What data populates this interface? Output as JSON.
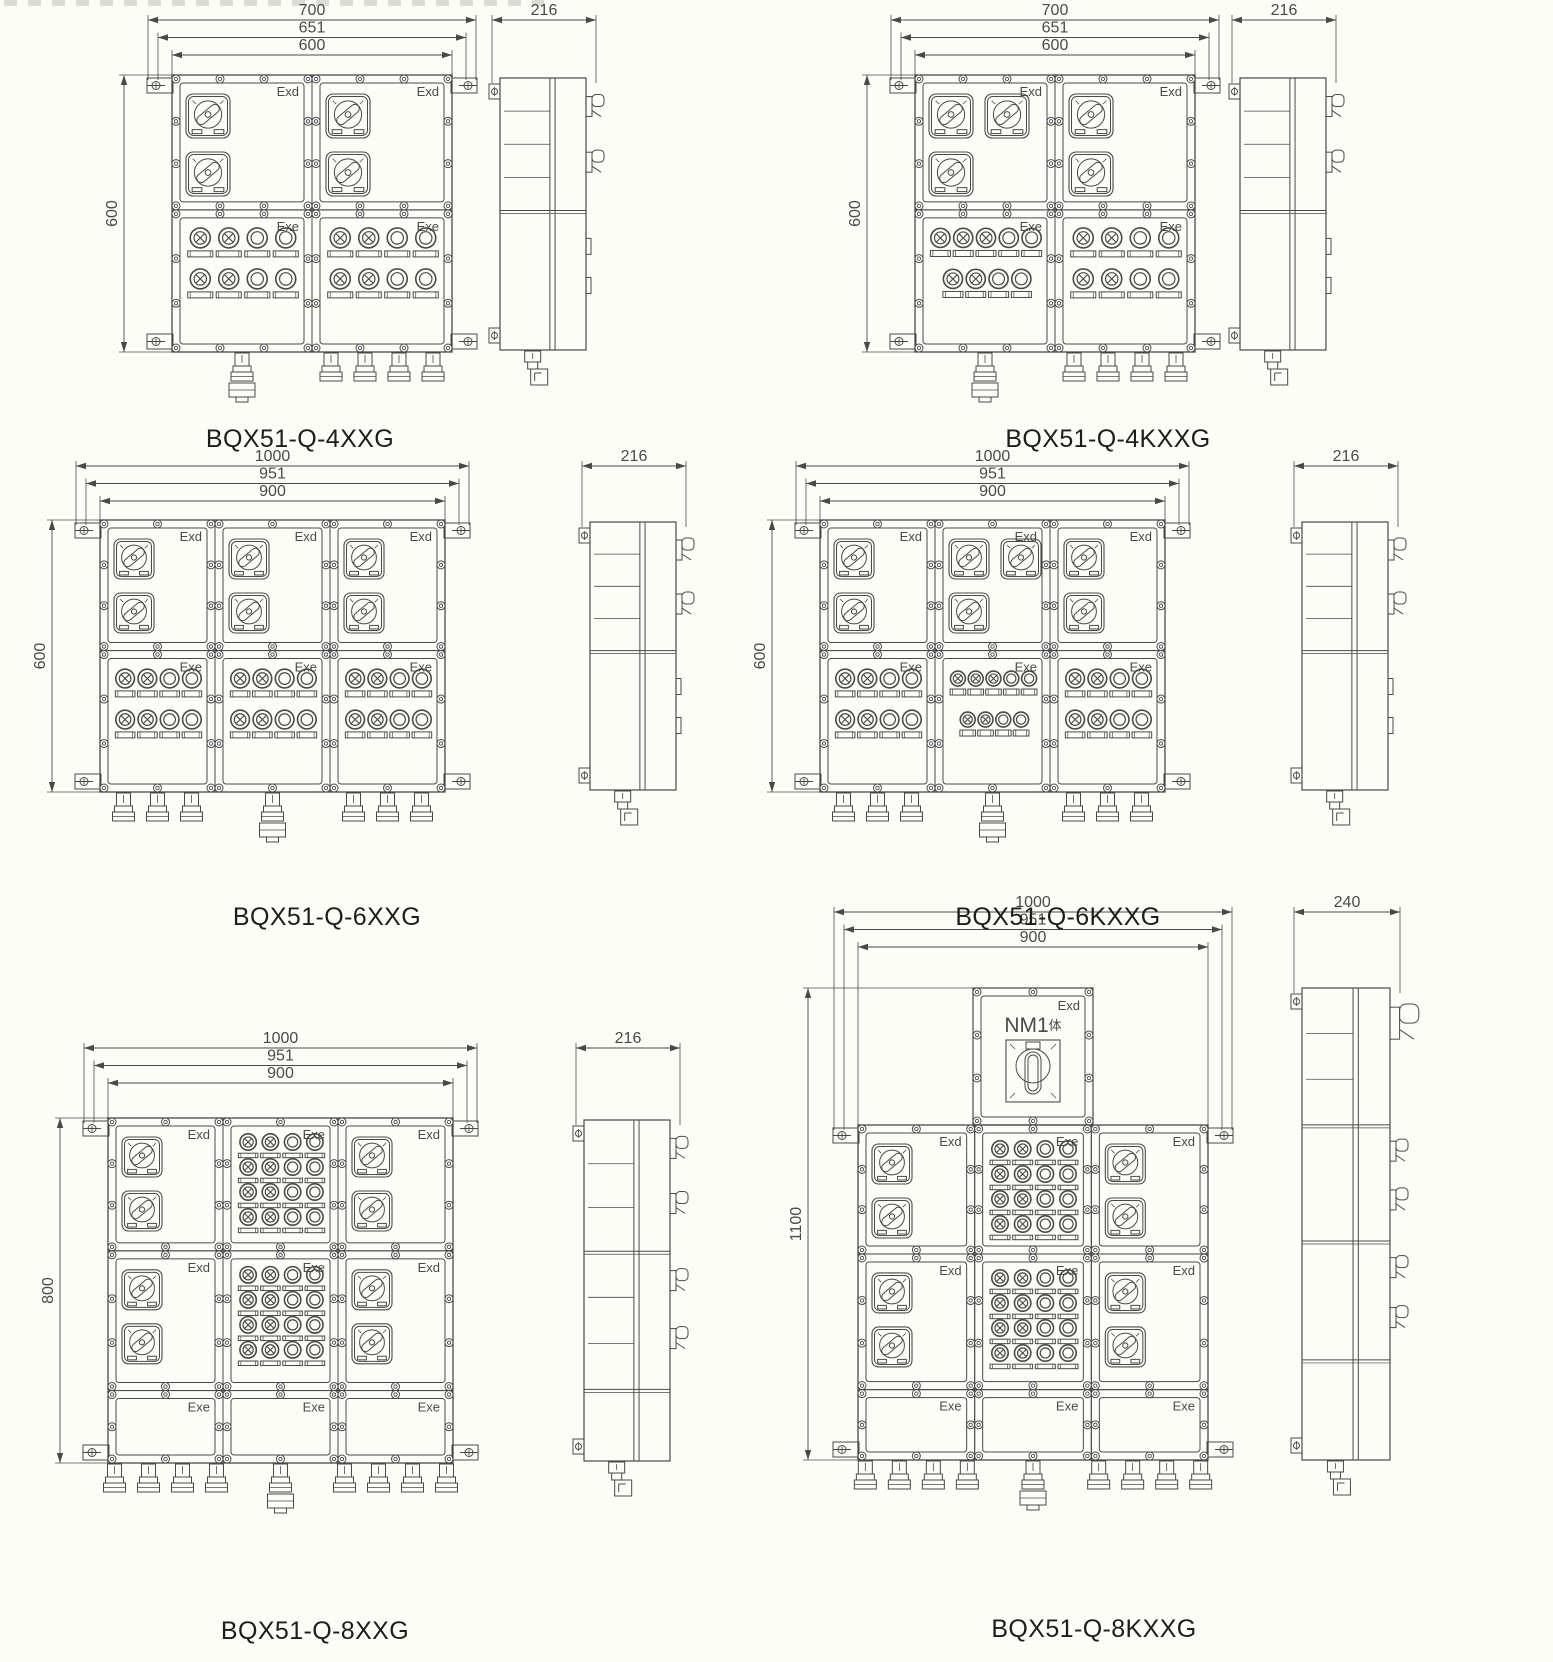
{
  "page": {
    "background": "#fdfdf8",
    "ink": "#494949",
    "caption_color": "#1d1d1d"
  },
  "figures": [
    {
      "id": "bqx51-q-4xxg",
      "caption": "BQX51-Q-4XXG",
      "dimensions": {
        "widths": [
          "700",
          "651",
          "600"
        ],
        "height": "600",
        "depth": "216"
      },
      "front": {
        "columns": 2,
        "rows": [
          {
            "cells": [
              {
                "type": "exd",
                "label": "Exd",
                "switches": [
                  [
                    0,
                    0
                  ],
                  [
                    0,
                    1
                  ]
                ]
              },
              {
                "type": "exd",
                "label": "Exd",
                "switches": [
                  [
                    0,
                    0
                  ],
                  [
                    0,
                    1
                  ]
                ]
              }
            ]
          },
          {
            "cells": [
              {
                "type": "exe",
                "label": "Exe",
                "circle_rows": [
                  "xxoo",
                  "xxoo"
                ]
              },
              {
                "type": "exe",
                "label": "Exe",
                "circle_rows": [
                  "xxoo",
                  "xxoo"
                ]
              }
            ]
          }
        ],
        "glands": [
          {
            "count": 1,
            "drain": true
          },
          {
            "count": 4,
            "drain": false
          }
        ]
      },
      "side": {
        "sections": [
          {
            "handles": 2,
            "shelves": 3
          },
          {
            "tabs": 2
          }
        ]
      }
    },
    {
      "id": "bqx51-q-4kxxg",
      "caption": "BQX51-Q-4KXXG",
      "dimensions": {
        "widths": [
          "700",
          "651",
          "600"
        ],
        "height": "600",
        "depth": "216"
      },
      "front": {
        "columns": 2,
        "rows": [
          {
            "cells": [
              {
                "type": "exd",
                "label": "Exd",
                "switches": [
                  [
                    0,
                    0
                  ],
                  [
                    1,
                    0
                  ],
                  [
                    0,
                    1
                  ]
                ]
              },
              {
                "type": "exd",
                "label": "Exd",
                "switches": [
                  [
                    0,
                    0
                  ],
                  [
                    0,
                    1
                  ]
                ]
              }
            ]
          },
          {
            "cells": [
              {
                "type": "exe",
                "label": "Exe",
                "circle_rows": [
                  "xxxoo",
                  "+xxoo"
                ]
              },
              {
                "type": "exe",
                "label": "Exe",
                "circle_rows": [
                  "xxoo",
                  "xxoo"
                ]
              }
            ]
          }
        ],
        "glands": [
          {
            "count": 1,
            "drain": true
          },
          {
            "count": 4,
            "drain": false
          }
        ]
      },
      "side": {
        "sections": [
          {
            "handles": 2,
            "shelves": 3
          },
          {
            "tabs": 2
          }
        ]
      }
    },
    {
      "id": "bqx51-q-6xxg",
      "caption": "BQX51-Q-6XXG",
      "dimensions": {
        "widths": [
          "1000",
          "951",
          "900"
        ],
        "height": "600",
        "depth": "216"
      },
      "front": {
        "columns": 3,
        "rows": [
          {
            "cells": [
              {
                "type": "exd",
                "label": "Exd",
                "switches": [
                  [
                    0,
                    0
                  ],
                  [
                    0,
                    1
                  ]
                ]
              },
              {
                "type": "exd",
                "label": "Exd",
                "switches": [
                  [
                    0,
                    0
                  ],
                  [
                    0,
                    1
                  ]
                ]
              },
              {
                "type": "exd",
                "label": "Exd",
                "switches": [
                  [
                    0,
                    0
                  ],
                  [
                    0,
                    1
                  ]
                ]
              }
            ]
          },
          {
            "cells": [
              {
                "type": "exe",
                "label": "Exe",
                "circle_rows": [
                  "xxoo",
                  "xxoo"
                ]
              },
              {
                "type": "exe",
                "label": "Exe",
                "circle_rows": [
                  "xxoo",
                  "xxoo"
                ]
              },
              {
                "type": "exe",
                "label": "Exe",
                "circle_rows": [
                  "xxoo",
                  "xxoo"
                ]
              }
            ]
          }
        ],
        "glands": [
          {
            "count": 3,
            "drain": false
          },
          {
            "count": 1,
            "drain": true
          },
          {
            "count": 3,
            "drain": false
          }
        ]
      },
      "side": {
        "sections": [
          {
            "handles": 2,
            "shelves": 3
          },
          {
            "tabs": 2
          }
        ]
      }
    },
    {
      "id": "bqx51-q-6kxxg",
      "caption": "BQX51-Q-6KXXG",
      "dimensions": {
        "widths": [
          "1000",
          "951",
          "900"
        ],
        "height": "600",
        "depth": "216"
      },
      "front": {
        "columns": 3,
        "rows": [
          {
            "cells": [
              {
                "type": "exd",
                "label": "Exd",
                "switches": [
                  [
                    0,
                    0
                  ],
                  [
                    0,
                    1
                  ]
                ]
              },
              {
                "type": "exd",
                "label": "Exd",
                "switches": [
                  [
                    0,
                    0
                  ],
                  [
                    1,
                    0
                  ],
                  [
                    0,
                    1
                  ]
                ]
              },
              {
                "type": "exd",
                "label": "Exd",
                "switches": [
                  [
                    0,
                    0
                  ],
                  [
                    0,
                    1
                  ]
                ]
              }
            ]
          },
          {
            "cells": [
              {
                "type": "exe",
                "label": "Exe",
                "circle_rows": [
                  "xxoo",
                  "xxoo"
                ]
              },
              {
                "type": "exe",
                "label": "Exe",
                "circle_rows": [
                  "xxxoo",
                  "+xxoo"
                ]
              },
              {
                "type": "exe",
                "label": "Exe",
                "circle_rows": [
                  "xxoo",
                  "xxoo"
                ]
              }
            ]
          }
        ],
        "glands": [
          {
            "count": 3,
            "drain": false
          },
          {
            "count": 1,
            "drain": true
          },
          {
            "count": 3,
            "drain": false
          }
        ]
      },
      "side": {
        "sections": [
          {
            "handles": 2,
            "shelves": 3
          },
          {
            "tabs": 2
          }
        ]
      }
    },
    {
      "id": "bqx51-q-8xxg",
      "caption": "BQX51-Q-8XXG",
      "dimensions": {
        "widths": [
          "1000",
          "951",
          "900"
        ],
        "height": "800",
        "depth": "216"
      },
      "front": {
        "columns": 3,
        "rows": [
          {
            "cells": [
              {
                "type": "exd",
                "label": "Exd",
                "switches": [
                  [
                    0,
                    0
                  ],
                  [
                    0,
                    1
                  ]
                ]
              },
              {
                "type": "exe",
                "label": "Exe",
                "circle_rows": [
                  "xxoo",
                  "xxoo",
                  "xxoo",
                  "xxoo"
                ]
              },
              {
                "type": "exd",
                "label": "Exd",
                "switches": [
                  [
                    0,
                    0
                  ],
                  [
                    0,
                    1
                  ]
                ]
              }
            ]
          },
          {
            "cells": [
              {
                "type": "exd",
                "label": "Exd",
                "switches": [
                  [
                    0,
                    0
                  ],
                  [
                    0,
                    1
                  ]
                ]
              },
              {
                "type": "exe",
                "label": "Exe",
                "circle_rows": [
                  "xxoo",
                  "xxoo",
                  "xxoo",
                  "xxoo"
                ]
              },
              {
                "type": "exd",
                "label": "Exd",
                "switches": [
                  [
                    0,
                    0
                  ],
                  [
                    0,
                    1
                  ]
                ]
              }
            ]
          },
          {
            "cells": [
              {
                "type": "exe",
                "label": "Exe"
              },
              {
                "type": "exe",
                "label": "Exe"
              },
              {
                "type": "exe",
                "label": "Exe"
              }
            ]
          }
        ],
        "glands": [
          {
            "count": 4,
            "drain": false
          },
          {
            "count": 1,
            "drain": true
          },
          {
            "count": 4,
            "drain": false
          }
        ]
      },
      "side": {
        "sections": [
          {
            "handles": 2,
            "shelves": 2
          },
          {
            "handles": 2,
            "shelves": 2
          },
          {}
        ]
      }
    },
    {
      "id": "bqx51-q-8kxxg",
      "caption": "BQX51-Q-8KXXG",
      "dimensions": {
        "widths": [
          "1000",
          "951",
          "900"
        ],
        "height": "1100",
        "depth": "240"
      },
      "top_compartment": {
        "label": "Exd",
        "title": "NM1",
        "title_suffix": "体"
      },
      "front": {
        "columns": 3,
        "rows": [
          {
            "cells": [
              {
                "type": "exd",
                "label": "Exd",
                "switches": [
                  [
                    0,
                    0
                  ],
                  [
                    0,
                    1
                  ]
                ]
              },
              {
                "type": "exe",
                "label": "Exe",
                "circle_rows": [
                  "xxoo",
                  "xxoo",
                  "xxoo",
                  "xxoo"
                ]
              },
              {
                "type": "exd",
                "label": "Exd",
                "switches": [
                  [
                    0,
                    0
                  ],
                  [
                    0,
                    1
                  ]
                ]
              }
            ]
          },
          {
            "cells": [
              {
                "type": "exd",
                "label": "Exd",
                "switches": [
                  [
                    0,
                    0
                  ],
                  [
                    0,
                    1
                  ]
                ]
              },
              {
                "type": "exe",
                "label": "Exe",
                "circle_rows": [
                  "xxoo",
                  "xxoo",
                  "xxoo",
                  "xxoo"
                ]
              },
              {
                "type": "exd",
                "label": "Exd",
                "switches": [
                  [
                    0,
                    0
                  ],
                  [
                    0,
                    1
                  ]
                ]
              }
            ]
          },
          {
            "cells": [
              {
                "type": "exe",
                "label": "Exe"
              },
              {
                "type": "exe",
                "label": "Exe"
              },
              {
                "type": "exe",
                "label": "Exe"
              }
            ]
          }
        ],
        "glands": [
          {
            "count": 4,
            "drain": false
          },
          {
            "count": 1,
            "drain": true
          },
          {
            "count": 4,
            "drain": false
          }
        ]
      },
      "side": {
        "sections": [
          {
            "handles": 1,
            "big": true,
            "shelves": 2
          },
          {
            "handles": 2
          },
          {
            "handles": 2
          },
          {}
        ]
      }
    }
  ]
}
